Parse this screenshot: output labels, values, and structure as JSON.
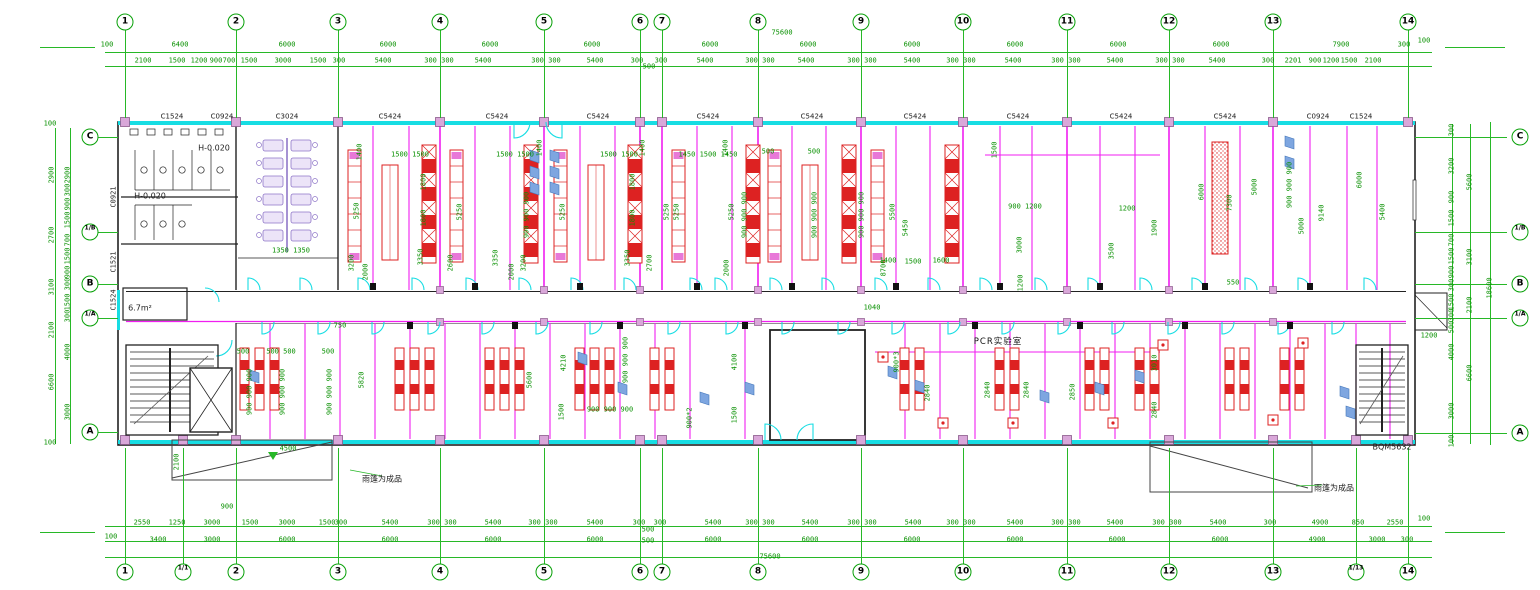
{
  "meta": {
    "drawing_type": "laboratory floor plan",
    "overall_width_mm": "75600",
    "overall_depth_mm": "18600",
    "product_code": "BQM5632"
  },
  "axes": {
    "top": [
      {
        "n": "1",
        "x": 125
      },
      {
        "n": "2",
        "x": 236
      },
      {
        "n": "3",
        "x": 338
      },
      {
        "n": "4",
        "x": 440
      },
      {
        "n": "5",
        "x": 544
      },
      {
        "n": "6",
        "x": 640
      },
      {
        "n": "7",
        "x": 662
      },
      {
        "n": "8",
        "x": 758
      },
      {
        "n": "9",
        "x": 861
      },
      {
        "n": "10",
        "x": 963
      },
      {
        "n": "11",
        "x": 1067
      },
      {
        "n": "12",
        "x": 1169
      },
      {
        "n": "13",
        "x": 1273
      },
      {
        "n": "14",
        "x": 1408
      }
    ],
    "bottom": [
      {
        "n": "1",
        "x": 125
      },
      {
        "n": "1/1",
        "x": 183
      },
      {
        "n": "2",
        "x": 236
      },
      {
        "n": "3",
        "x": 338
      },
      {
        "n": "4",
        "x": 440
      },
      {
        "n": "5",
        "x": 544
      },
      {
        "n": "6",
        "x": 640
      },
      {
        "n": "7",
        "x": 662
      },
      {
        "n": "8",
        "x": 758
      },
      {
        "n": "9",
        "x": 861
      },
      {
        "n": "10",
        "x": 963
      },
      {
        "n": "11",
        "x": 1067
      },
      {
        "n": "12",
        "x": 1169
      },
      {
        "n": "13",
        "x": 1273
      },
      {
        "n": "1/13",
        "x": 1356
      },
      {
        "n": "14",
        "x": 1408
      }
    ],
    "left": [
      {
        "n": "C",
        "y": 137
      },
      {
        "n": "1/B",
        "y": 232
      },
      {
        "n": "B",
        "y": 284
      },
      {
        "n": "1/A",
        "y": 318
      },
      {
        "n": "A",
        "y": 432
      }
    ],
    "right": [
      {
        "n": "C",
        "y": 137
      },
      {
        "n": "1/B",
        "y": 232
      },
      {
        "n": "B",
        "y": 284
      },
      {
        "n": "1/A",
        "y": 318
      },
      {
        "n": "A",
        "y": 433
      }
    ]
  },
  "labels": [
    [
      "100",
      107,
      45,
      "g"
    ],
    [
      "6400",
      180,
      45,
      "g"
    ],
    [
      "6000",
      287,
      45,
      "g"
    ],
    [
      "6000",
      388,
      45,
      "g"
    ],
    [
      "6000",
      490,
      45,
      "g"
    ],
    [
      "6000",
      592,
      45,
      "g"
    ],
    [
      "6000",
      710,
      45,
      "g"
    ],
    [
      "6000",
      808,
      45,
      "g"
    ],
    [
      "6000",
      912,
      45,
      "g"
    ],
    [
      "6000",
      1015,
      45,
      "g"
    ],
    [
      "6000",
      1118,
      45,
      "g"
    ],
    [
      "6000",
      1221,
      45,
      "g"
    ],
    [
      "7900",
      1341,
      45,
      "g"
    ],
    [
      "300",
      1404,
      45,
      "g"
    ],
    [
      "100",
      1424,
      41,
      "g"
    ],
    [
      "75600",
      782,
      33,
      "g"
    ],
    [
      "2100",
      143,
      61,
      "g"
    ],
    [
      "1500",
      177,
      61,
      "g"
    ],
    [
      "1200",
      199,
      61,
      "g"
    ],
    [
      "900",
      216,
      61,
      "g"
    ],
    [
      "700",
      229,
      61,
      "g"
    ],
    [
      "1500",
      249,
      61,
      "g"
    ],
    [
      "3000",
      283,
      61,
      "g"
    ],
    [
      "1500",
      318,
      61,
      "g"
    ],
    [
      "300",
      339,
      61,
      "g"
    ],
    [
      "5400",
      383,
      61,
      "g"
    ],
    [
      "300 300",
      439,
      61,
      "g"
    ],
    [
      "5400",
      483,
      61,
      "g"
    ],
    [
      "300 300",
      546,
      61,
      "g"
    ],
    [
      "5400",
      595,
      61,
      "g"
    ],
    [
      "300",
      637,
      61,
      "g"
    ],
    [
      "500",
      649,
      67,
      "g"
    ],
    [
      "300",
      661,
      61,
      "g"
    ],
    [
      "5400",
      705,
      61,
      "g"
    ],
    [
      "300 300",
      760,
      61,
      "g"
    ],
    [
      "5400",
      806,
      61,
      "g"
    ],
    [
      "300 300",
      862,
      61,
      "g"
    ],
    [
      "5400",
      912,
      61,
      "g"
    ],
    [
      "300 300",
      961,
      61,
      "g"
    ],
    [
      "5400",
      1013,
      61,
      "g"
    ],
    [
      "300 300",
      1066,
      61,
      "g"
    ],
    [
      "5400",
      1115,
      61,
      "g"
    ],
    [
      "300 300",
      1170,
      61,
      "g"
    ],
    [
      "5400",
      1217,
      61,
      "g"
    ],
    [
      "300",
      1268,
      61,
      "g"
    ],
    [
      "2201",
      1293,
      61,
      "g"
    ],
    [
      "900",
      1315,
      61,
      "g"
    ],
    [
      "1200",
      1331,
      61,
      "g"
    ],
    [
      "1500",
      1349,
      61,
      "g"
    ],
    [
      "2100",
      1373,
      61,
      "g"
    ],
    [
      "2550",
      142,
      523,
      "g"
    ],
    [
      "1250",
      177,
      523,
      "g"
    ],
    [
      "3000",
      212,
      523,
      "g"
    ],
    [
      "1500",
      250,
      523,
      "g"
    ],
    [
      "3000",
      287,
      523,
      "g"
    ],
    [
      "1500",
      327,
      523,
      "g"
    ],
    [
      "300",
      341,
      523,
      "g"
    ],
    [
      "5400",
      390,
      523,
      "g"
    ],
    [
      "300 300",
      442,
      523,
      "g"
    ],
    [
      "5400",
      493,
      523,
      "g"
    ],
    [
      "300 300",
      543,
      523,
      "g"
    ],
    [
      "5400",
      595,
      523,
      "g"
    ],
    [
      "300",
      639,
      523,
      "g"
    ],
    [
      "500",
      648,
      530,
      "g"
    ],
    [
      "300",
      660,
      523,
      "g"
    ],
    [
      "5400",
      713,
      523,
      "g"
    ],
    [
      "300 300",
      760,
      523,
      "g"
    ],
    [
      "5400",
      810,
      523,
      "g"
    ],
    [
      "300 300",
      862,
      523,
      "g"
    ],
    [
      "5400",
      913,
      523,
      "g"
    ],
    [
      "300 300",
      961,
      523,
      "g"
    ],
    [
      "5400",
      1015,
      523,
      "g"
    ],
    [
      "300 300",
      1066,
      523,
      "g"
    ],
    [
      "5400",
      1115,
      523,
      "g"
    ],
    [
      "300 300",
      1167,
      523,
      "g"
    ],
    [
      "5400",
      1218,
      523,
      "g"
    ],
    [
      "300",
      1270,
      523,
      "g"
    ],
    [
      "4900",
      1320,
      523,
      "g"
    ],
    [
      "850",
      1358,
      523,
      "g"
    ],
    [
      "2550",
      1395,
      523,
      "g"
    ],
    [
      "100",
      1424,
      519,
      "g"
    ],
    [
      "100",
      111,
      537,
      "g"
    ],
    [
      "3400",
      158,
      540,
      "g"
    ],
    [
      "3000",
      212,
      540,
      "g"
    ],
    [
      "6000",
      287,
      540,
      "g"
    ],
    [
      "6000",
      390,
      540,
      "g"
    ],
    [
      "6000",
      493,
      540,
      "g"
    ],
    [
      "6000",
      595,
      540,
      "g"
    ],
    [
      "500",
      648,
      541,
      "g"
    ],
    [
      "6000",
      713,
      540,
      "g"
    ],
    [
      "6000",
      810,
      540,
      "g"
    ],
    [
      "6000",
      912,
      540,
      "g"
    ],
    [
      "6000",
      1015,
      540,
      "g"
    ],
    [
      "6000",
      1117,
      540,
      "g"
    ],
    [
      "6000",
      1220,
      540,
      "g"
    ],
    [
      "4900",
      1317,
      540,
      "g"
    ],
    [
      "3000",
      1377,
      540,
      "g"
    ],
    [
      "300",
      1407,
      540,
      "g"
    ],
    [
      "75600",
      770,
      557,
      "g"
    ],
    [
      "900",
      227,
      507,
      "g"
    ],
    [
      "4500",
      288,
      449,
      "g"
    ],
    [
      "2100",
      177,
      462,
      "gv"
    ],
    [
      "1200",
      1429,
      336,
      "g"
    ],
    [
      "2900",
      52,
      175,
      "gv"
    ],
    [
      "2700",
      52,
      235,
      "gv"
    ],
    [
      "3100",
      52,
      287,
      "gv"
    ],
    [
      "2100",
      52,
      330,
      "gv"
    ],
    [
      "6600",
      52,
      382,
      "gv"
    ],
    [
      "2900",
      68,
      175,
      "gv"
    ],
    [
      "300",
      68,
      190,
      "gv"
    ],
    [
      "900",
      68,
      204,
      "gv"
    ],
    [
      "1500",
      68,
      220,
      "gv"
    ],
    [
      "700",
      68,
      240,
      "gv"
    ],
    [
      "1500",
      68,
      256,
      "gv"
    ],
    [
      "900",
      68,
      272,
      "gv"
    ],
    [
      "300",
      68,
      284,
      "gv"
    ],
    [
      "1500",
      68,
      302,
      "gv"
    ],
    [
      "300",
      68,
      316,
      "gv"
    ],
    [
      "4000",
      68,
      352,
      "gv"
    ],
    [
      "3000",
      68,
      412,
      "gv"
    ],
    [
      "100",
      50,
      124,
      "g"
    ],
    [
      "100",
      50,
      443,
      "g"
    ],
    [
      "300",
      1452,
      130,
      "gv"
    ],
    [
      "3200",
      1452,
      166,
      "gv"
    ],
    [
      "900",
      1452,
      197,
      "gv"
    ],
    [
      "1500",
      1452,
      218,
      "gv"
    ],
    [
      "700",
      1452,
      240,
      "gv"
    ],
    [
      "1500",
      1452,
      256,
      "gv"
    ],
    [
      "900",
      1452,
      272,
      "gv"
    ],
    [
      "300",
      1452,
      285,
      "gv"
    ],
    [
      "1500",
      1452,
      302,
      "gv"
    ],
    [
      "300",
      1452,
      315,
      "gv"
    ],
    [
      "500",
      1452,
      327,
      "gv"
    ],
    [
      "4000",
      1452,
      352,
      "gv"
    ],
    [
      "3000",
      1452,
      411,
      "gv"
    ],
    [
      "100",
      1452,
      441,
      "gv"
    ],
    [
      "5600",
      1470,
      182,
      "gv"
    ],
    [
      "3100",
      1470,
      257,
      "gv"
    ],
    [
      "2100",
      1470,
      305,
      "gv"
    ],
    [
      "6600",
      1470,
      373,
      "gv"
    ],
    [
      "18600",
      1490,
      288,
      "gv"
    ],
    [
      "C1524",
      172,
      117,
      "k"
    ],
    [
      "C0924",
      222,
      117,
      "k"
    ],
    [
      "C3024",
      287,
      117,
      "k"
    ],
    [
      "C5424",
      390,
      117,
      "k"
    ],
    [
      "C5424",
      497,
      117,
      "k"
    ],
    [
      "C5424",
      598,
      117,
      "k"
    ],
    [
      "C5424",
      708,
      117,
      "k"
    ],
    [
      "C5424",
      812,
      117,
      "k"
    ],
    [
      "C5424",
      915,
      117,
      "k"
    ],
    [
      "C5424",
      1018,
      117,
      "k"
    ],
    [
      "C5424",
      1121,
      117,
      "k"
    ],
    [
      "C5424",
      1225,
      117,
      "k"
    ],
    [
      "C0924",
      1318,
      117,
      "k"
    ],
    [
      "C1524",
      1361,
      117,
      "k"
    ],
    [
      "C0921",
      114,
      197,
      "kv"
    ],
    [
      "C1521",
      114,
      262,
      "kv"
    ],
    [
      "C1524",
      114,
      300,
      "kv"
    ],
    [
      "H-0.020",
      214,
      148,
      "an"
    ],
    [
      "H-0.020",
      150,
      196,
      "an"
    ],
    [
      "6.7m²",
      140,
      308,
      "an"
    ],
    [
      "PCR实验室",
      998,
      341,
      "kb"
    ],
    [
      "雨篷为成品",
      382,
      479,
      "an"
    ],
    [
      "雨篷为成品",
      1334,
      488,
      "an"
    ],
    [
      "BQM5632",
      1392,
      447,
      "an"
    ],
    [
      "1350 1350",
      291,
      251,
      "g"
    ],
    [
      "1400",
      360,
      152,
      "gv"
    ],
    [
      "5250",
      357,
      211,
      "gv"
    ],
    [
      "3200",
      352,
      263,
      "gv"
    ],
    [
      "2000",
      366,
      272,
      "gv"
    ],
    [
      "1500 1500",
      410,
      155,
      "g"
    ],
    [
      "1800",
      424,
      182,
      "gv"
    ],
    [
      "1800",
      424,
      218,
      "gv"
    ],
    [
      "5250",
      460,
      212,
      "gv"
    ],
    [
      "3350",
      421,
      257,
      "gv"
    ],
    [
      "2600",
      451,
      263,
      "gv"
    ],
    [
      "1500 1500",
      515,
      155,
      "g"
    ],
    [
      "1400",
      540,
      148,
      "gv"
    ],
    [
      "900 900 900",
      527,
      215,
      "gv"
    ],
    [
      "5250",
      563,
      212,
      "gv"
    ],
    [
      "3350",
      496,
      258,
      "gv"
    ],
    [
      "3200",
      524,
      263,
      "gv"
    ],
    [
      "2000",
      512,
      272,
      "gv"
    ],
    [
      "1500 1500",
      619,
      155,
      "g"
    ],
    [
      "1400",
      643,
      148,
      "gv"
    ],
    [
      "1800",
      633,
      182,
      "gv"
    ],
    [
      "1800",
      633,
      218,
      "gv"
    ],
    [
      "5250",
      667,
      212,
      "gv"
    ],
    [
      "3350",
      628,
      258,
      "gv"
    ],
    [
      "2700",
      650,
      263,
      "gv"
    ],
    [
      "1450 1500 1450",
      708,
      155,
      "g"
    ],
    [
      "1400",
      726,
      148,
      "gv"
    ],
    [
      "5250",
      677,
      212,
      "gv"
    ],
    [
      "900 900 900",
      745,
      215,
      "gv"
    ],
    [
      "5250",
      732,
      212,
      "gv"
    ],
    [
      "2000",
      727,
      268,
      "gv"
    ],
    [
      "500",
      768,
      152,
      "g"
    ],
    [
      "500",
      814,
      152,
      "g"
    ],
    [
      "900 900 900",
      815,
      215,
      "gv"
    ],
    [
      "900 900 900",
      862,
      215,
      "gv"
    ],
    [
      "5500",
      893,
      212,
      "gv"
    ],
    [
      "5450",
      906,
      228,
      "gv"
    ],
    [
      "8700",
      884,
      268,
      "gv"
    ],
    [
      "1400",
      888,
      261,
      "g"
    ],
    [
      "1500",
      913,
      262,
      "g"
    ],
    [
      "1600",
      941,
      261,
      "g"
    ],
    [
      "1500",
      995,
      150,
      "gv"
    ],
    [
      "900 1200",
      1025,
      207,
      "g"
    ],
    [
      "3000",
      1020,
      245,
      "gv"
    ],
    [
      "1200",
      1021,
      283,
      "gv"
    ],
    [
      "1200",
      1127,
      209,
      "g"
    ],
    [
      "3500",
      1112,
      251,
      "gv"
    ],
    [
      "1900",
      1155,
      228,
      "gv"
    ],
    [
      "6000",
      1202,
      192,
      "gv"
    ],
    [
      "7300",
      1230,
      203,
      "gv"
    ],
    [
      "5000",
      1255,
      187,
      "gv"
    ],
    [
      "550",
      1233,
      283,
      "g"
    ],
    [
      "900 900 900",
      1290,
      185,
      "gv"
    ],
    [
      "5000",
      1302,
      226,
      "gv"
    ],
    [
      "9140",
      1322,
      213,
      "gv"
    ],
    [
      "6000",
      1360,
      180,
      "gv"
    ],
    [
      "5400",
      1383,
      212,
      "gv"
    ],
    [
      "1040",
      872,
      308,
      "g"
    ],
    [
      "900*3",
      897,
      362,
      "gv"
    ],
    [
      "2840",
      928,
      393,
      "gv"
    ],
    [
      "2840",
      988,
      390,
      "gv"
    ],
    [
      "2840",
      1027,
      390,
      "gv"
    ],
    [
      "2850",
      1073,
      392,
      "gv"
    ],
    [
      "3010",
      1155,
      363,
      "gv"
    ],
    [
      "2840",
      1155,
      410,
      "gv"
    ],
    [
      "4210",
      564,
      363,
      "gv"
    ],
    [
      "1500",
      562,
      412,
      "gv"
    ],
    [
      "900 900 900",
      626,
      360,
      "gv"
    ],
    [
      "900 900 900",
      610,
      410,
      "g"
    ],
    [
      "4100",
      735,
      362,
      "gv"
    ],
    [
      "900*2",
      690,
      418,
      "gv"
    ],
    [
      "1500",
      735,
      415,
      "gv"
    ],
    [
      "500",
      243,
      352,
      "g"
    ],
    [
      "500 500",
      281,
      352,
      "g"
    ],
    [
      "500",
      328,
      352,
      "g"
    ],
    [
      "900 900 900",
      250,
      392,
      "gv"
    ],
    [
      "900 900 900",
      283,
      392,
      "gv"
    ],
    [
      "900 900 900",
      330,
      392,
      "gv"
    ],
    [
      "750",
      340,
      326,
      "g"
    ],
    [
      "5820",
      362,
      380,
      "gv"
    ],
    [
      "5600",
      530,
      380,
      "gv"
    ]
  ]
}
